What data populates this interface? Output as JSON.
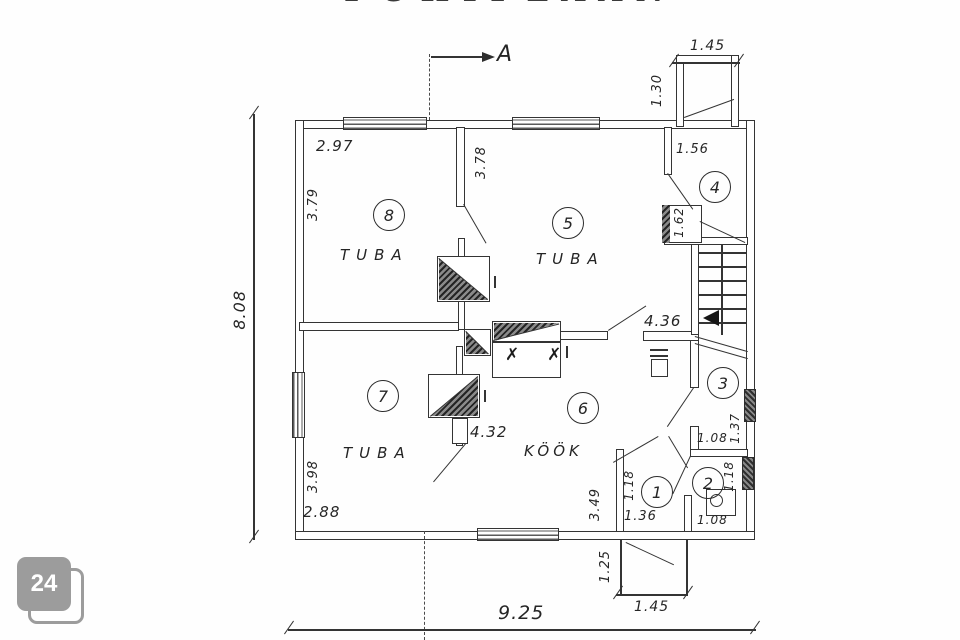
{
  "title": {
    "clipped_text": "PÕHIPLAAN"
  },
  "section_marker": {
    "label": "A"
  },
  "watermark": {
    "label": "24",
    "fill": "#9c9c9c",
    "text_color": "#ffffff"
  },
  "rooms": {
    "r1": {
      "number": "1"
    },
    "r2": {
      "number": "2"
    },
    "r3": {
      "number": "3"
    },
    "r4": {
      "number": "4"
    },
    "r5": {
      "number": "5",
      "name": "TUBA"
    },
    "r6": {
      "number": "6",
      "name": "KÖÖK"
    },
    "r7": {
      "number": "7",
      "name": "TUBA"
    },
    "r8": {
      "number": "8",
      "name": "TUBA"
    }
  },
  "fixtures": {
    "range_marks": "✗ ✗"
  },
  "dimensions": {
    "total_width": "9.25",
    "total_height": "8.08",
    "room8_width": "2.97",
    "room8_height": "3.79",
    "room5_height": "3.78",
    "room7_height": "3.98",
    "room7_width": "2.88",
    "kitchen_width": "4.32",
    "hall_width": "4.36",
    "kitchen_door_offset": "3.49",
    "porch_top_width": "1.45",
    "porch_top_depth": "1.30",
    "room4_entry_width": "1.56",
    "room4_closet_depth": "1.62",
    "room3_width": "1.08",
    "room3_depth": "1.37",
    "wc_depth": "1.18",
    "wc_width": "1.08",
    "entry_depth": "1.18",
    "entry_width": "1.36",
    "porch_bottom_depth": "1.25",
    "porch_bottom_width": "1.45"
  }
}
